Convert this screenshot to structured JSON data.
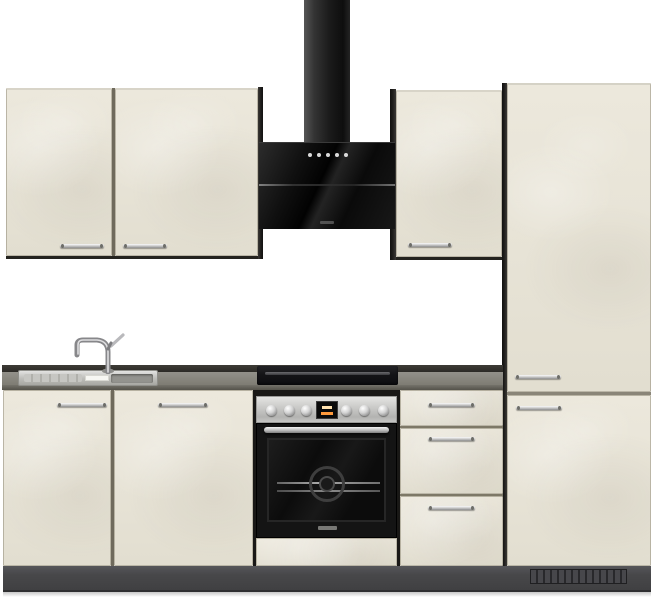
{
  "scene": {
    "kind": "kitchen-unit product photo",
    "background": "#ffffff",
    "front_finish": "off-white concrete look",
    "carcass_finish": "anthracite"
  },
  "colors": {
    "cabinet_front": "#e8e4d8",
    "carcass_dark": "#1d1c1a",
    "plinth": "#48484a",
    "countertop": "#86847c",
    "countertop_rail": "#34322e",
    "appliance_black": "#141414",
    "stainless": "#c9c9c7",
    "chrome_handle": "#cfcfcf",
    "oven_display_segment": "#ff9a3c"
  },
  "components": {
    "extractor_hood": {
      "type": "head-free chimney hood, black glass",
      "touch_buttons": 5
    },
    "wall_cabinet_left": {
      "doors": 2
    },
    "wall_cabinet_right": {
      "doors": 1
    },
    "tall_cabinet": {
      "doors": 2,
      "plinth_vent_grille": true
    },
    "base_left": {
      "doors": 2
    },
    "sink": {
      "type": "inset stainless sink",
      "faucet": "chrome single-lever mixer",
      "sticker": true
    },
    "cooktop": {
      "type": "black ceramic hob"
    },
    "oven": {
      "knobs": 6,
      "display": "black panel with orange segments",
      "handle": "stainless bar",
      "brand_logo": "illegible"
    },
    "drawer_unit": {
      "drawers": 3
    }
  }
}
